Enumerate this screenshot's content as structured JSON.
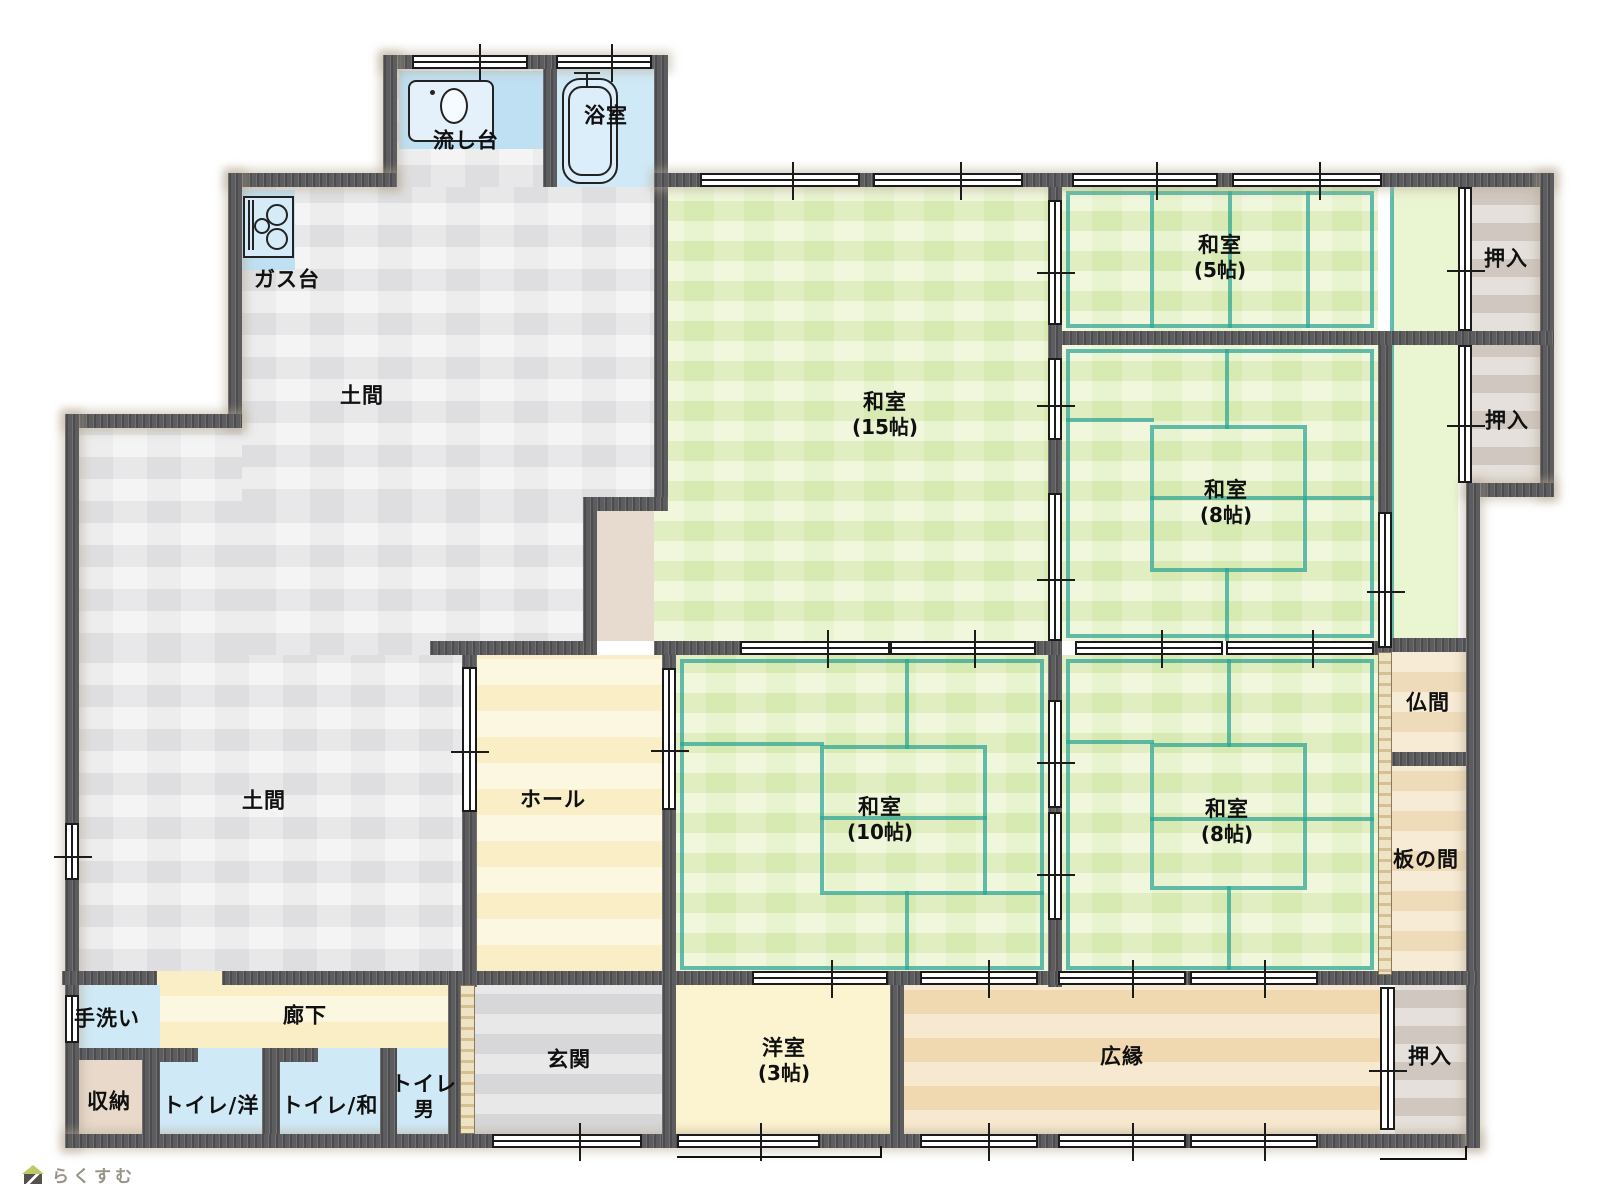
{
  "rooms": {
    "nagashidai": {
      "label": "流し台"
    },
    "yokushitsu": {
      "label": "浴室"
    },
    "gasudai": {
      "label": "ガス台"
    },
    "doma1": {
      "label": "土間"
    },
    "doma2": {
      "label": "土間"
    },
    "washitsu15": {
      "label": "和室",
      "size": "(15帖)"
    },
    "washitsu5": {
      "label": "和室",
      "size": "(5帖)"
    },
    "oshiire1": {
      "label": "押入"
    },
    "oshiire2": {
      "label": "押入"
    },
    "washitsu8mid": {
      "label": "和室",
      "size": "(8帖)"
    },
    "hall": {
      "label": "ホール"
    },
    "washitsu10": {
      "label": "和室",
      "size": "(10帖)"
    },
    "washitsu8btm": {
      "label": "和室",
      "size": "(8帖)"
    },
    "butsuma": {
      "label": "仏間"
    },
    "itanoma": {
      "label": "板の間"
    },
    "tearai": {
      "label": "手洗い"
    },
    "rouka": {
      "label": "廊下"
    },
    "shuno": {
      "label": "収納"
    },
    "toiletYo": {
      "label": "トイレ/洋"
    },
    "toiletWa": {
      "label": "トイレ/和"
    },
    "toiletMen": {
      "line1": "トイレ",
      "line2": "男"
    },
    "genkan": {
      "label": "玄関"
    },
    "youshitsu3": {
      "label": "洋室",
      "size": "(3帖)"
    },
    "hiroen": {
      "label": "広縁"
    },
    "oshiireBtm": {
      "label": "押入"
    }
  },
  "logo": {
    "text": "らくすむ",
    "icon": "house-icon"
  },
  "colors": {
    "wall": "#5d5d5f",
    "tatami": "#e4f2c3",
    "tatamiPale": "#eaf5d2",
    "tatamiLine": "#2ba394",
    "water": "#cfe9f7",
    "waterDeep": "#bfe0f2",
    "doma": "#e8e8ea",
    "hall": "#fbf4d3",
    "cream": "#fcf3d0",
    "engawa": "#f4dfba",
    "tanRoom": "#f3e2c3",
    "closet": "#d7cfc8",
    "genkan": "#dedee0",
    "storage": "#e8d9cb",
    "step": "#e6dbce",
    "logoText": "#98938a",
    "logoRoof": "#bcc966",
    "logoBody": "#55524e"
  }
}
